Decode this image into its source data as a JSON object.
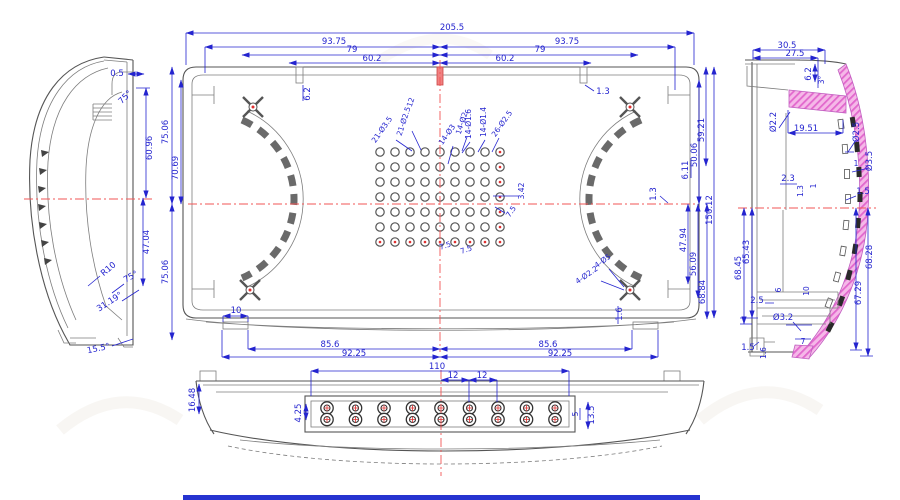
{
  "colors": {
    "dimension": "#2424cf",
    "outline": "#555555",
    "centerline": "#f25555",
    "section_fill": "#f5b8e8",
    "section_hatch": "#e267cd",
    "highlight_slot": "#f08080",
    "frame_bar": "#2633d0"
  },
  "views": {
    "top": {
      "dims": {
        "w205_5": "205.5",
        "w93_75_l": "93.75",
        "w93_75_r": "93.75",
        "w79_l": "79",
        "w79_r": "79",
        "w60_2_l": "60.2",
        "w60_2_r": "60.2",
        "slot6_2": "6.2",
        "slot1_3": "1.3",
        "h75_06_a": "75.06",
        "h70_69": "70.69",
        "h75_06_b": "75.06",
        "r59_21": "59.21",
        "r50_06": "50.06",
        "r6_11": "6.11",
        "r1_3": "1.3",
        "r150_12": "150.12",
        "r47_94": "47.94",
        "r56_09": "56.09",
        "r68_84": "68.84",
        "b10": "10",
        "b85_6_l": "85.6",
        "b92_25_l": "92.25",
        "b85_6_r": "85.6",
        "b92_25_r": "92.25",
        "b1_6": "1.6"
      },
      "holes": {
        "a": "21-Ø3.5",
        "b": "21-Ø2.5",
        "c": "12",
        "d": "14-Ø3",
        "e": "14-Ø2",
        "f": "14-Ø1.6",
        "g": "14-Ø1.4",
        "h": "26-Ø2.5",
        "i": "3.42",
        "j": "7.5",
        "k": "7.5",
        "l": "7.5",
        "m": "4-Ø5",
        "n": "4-Ø2.2"
      },
      "grid": {
        "cols": 9,
        "rows": 7,
        "x0": 380,
        "y0": 152,
        "dx": 15,
        "dy": 15,
        "r": 4.2
      }
    },
    "left": {
      "dims": {
        "t0_5": "0.5",
        "a75t": "75°",
        "h60_96": "60.96",
        "h47_04": "47.04",
        "r10": "R10",
        "a75b": "75°",
        "a31_19": "31.19°",
        "a15_5": "15.5°"
      }
    },
    "right": {
      "dims": {
        "w30_5": "30.5",
        "w27_5": "27.5",
        "v6_2": "6.2",
        "a3": "3°",
        "d2_2": "Ø2.2",
        "w19_51": "19.51",
        "d2_5": "Ø2.5",
        "n1a": "1",
        "d3_5": "Ø3.5",
        "n1_5a": "1.5",
        "n2_3": "2.3",
        "n1_3": "1.3",
        "n1b": "1",
        "h65_43": "65.43",
        "h68_45": "68.45",
        "n2_5": "2.5",
        "n6": "6",
        "n10": "10",
        "h67_29": "67.29",
        "h68_28": "68.28",
        "d3_2": "Ø3.2",
        "n7": "7",
        "n1_5b": "1.5",
        "n1_6": "1.6"
      },
      "grid": null
    },
    "bottom": {
      "dims": {
        "h16_48": "16.48",
        "w110": "110",
        "w12a": "12",
        "w12b": "12",
        "h4_25": "4.25",
        "h13_5": "13.5",
        "n5": "5"
      },
      "grid": {
        "cols": 9,
        "rows": 2,
        "x0": 327,
        "y0": 408,
        "dx": 28.5,
        "dy": 11.5,
        "r_outer": 6.2,
        "r_inner": 3
      }
    }
  }
}
